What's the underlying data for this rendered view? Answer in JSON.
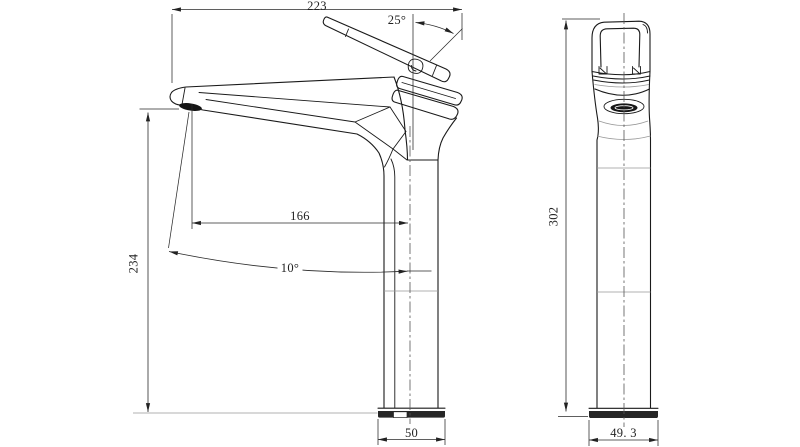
{
  "drawing": {
    "background": "#ffffff",
    "ink_color": "#1a1a1a",
    "dim_color": "#2a2a2a",
    "side_view": {
      "dim_overall_length": "223",
      "dim_handle_angle": "25°",
      "dim_spout_reach": "166",
      "dim_spout_angle": "10°",
      "dim_spout_height": "234",
      "dim_base_width": "50"
    },
    "front_view": {
      "dim_overall_height": "302",
      "dim_base_width": "49. 3"
    }
  }
}
